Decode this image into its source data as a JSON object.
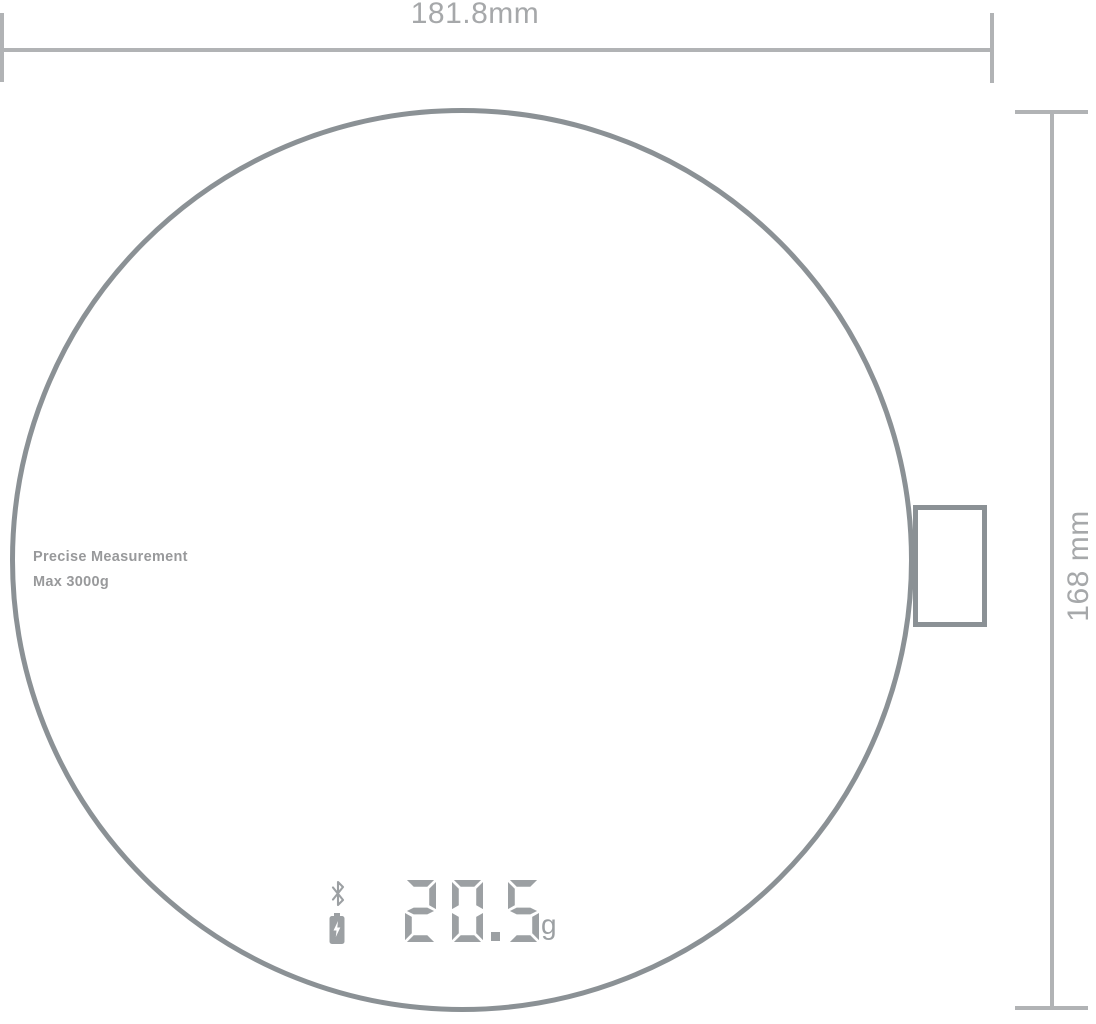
{
  "diagram": {
    "title": "kitchen scale dimension drawing",
    "width_dimension": {
      "label": "181.8mm"
    },
    "height_dimension": {
      "label": "168 mm"
    }
  },
  "scale": {
    "print": {
      "line1": "Precise Measurement",
      "line2": "Max 3000g"
    },
    "display": {
      "value": "20.5",
      "unit": "g",
      "icons": [
        "bluetooth-icon",
        "battery-charging-icon"
      ]
    }
  },
  "colors": {
    "outline": "#8b9195",
    "dimension_line": "#b1b3b5",
    "dimension_text": "#a6a8aa",
    "display_gray": "#9ca0a3",
    "print_text": "#98999b",
    "background": "#ffffff"
  }
}
